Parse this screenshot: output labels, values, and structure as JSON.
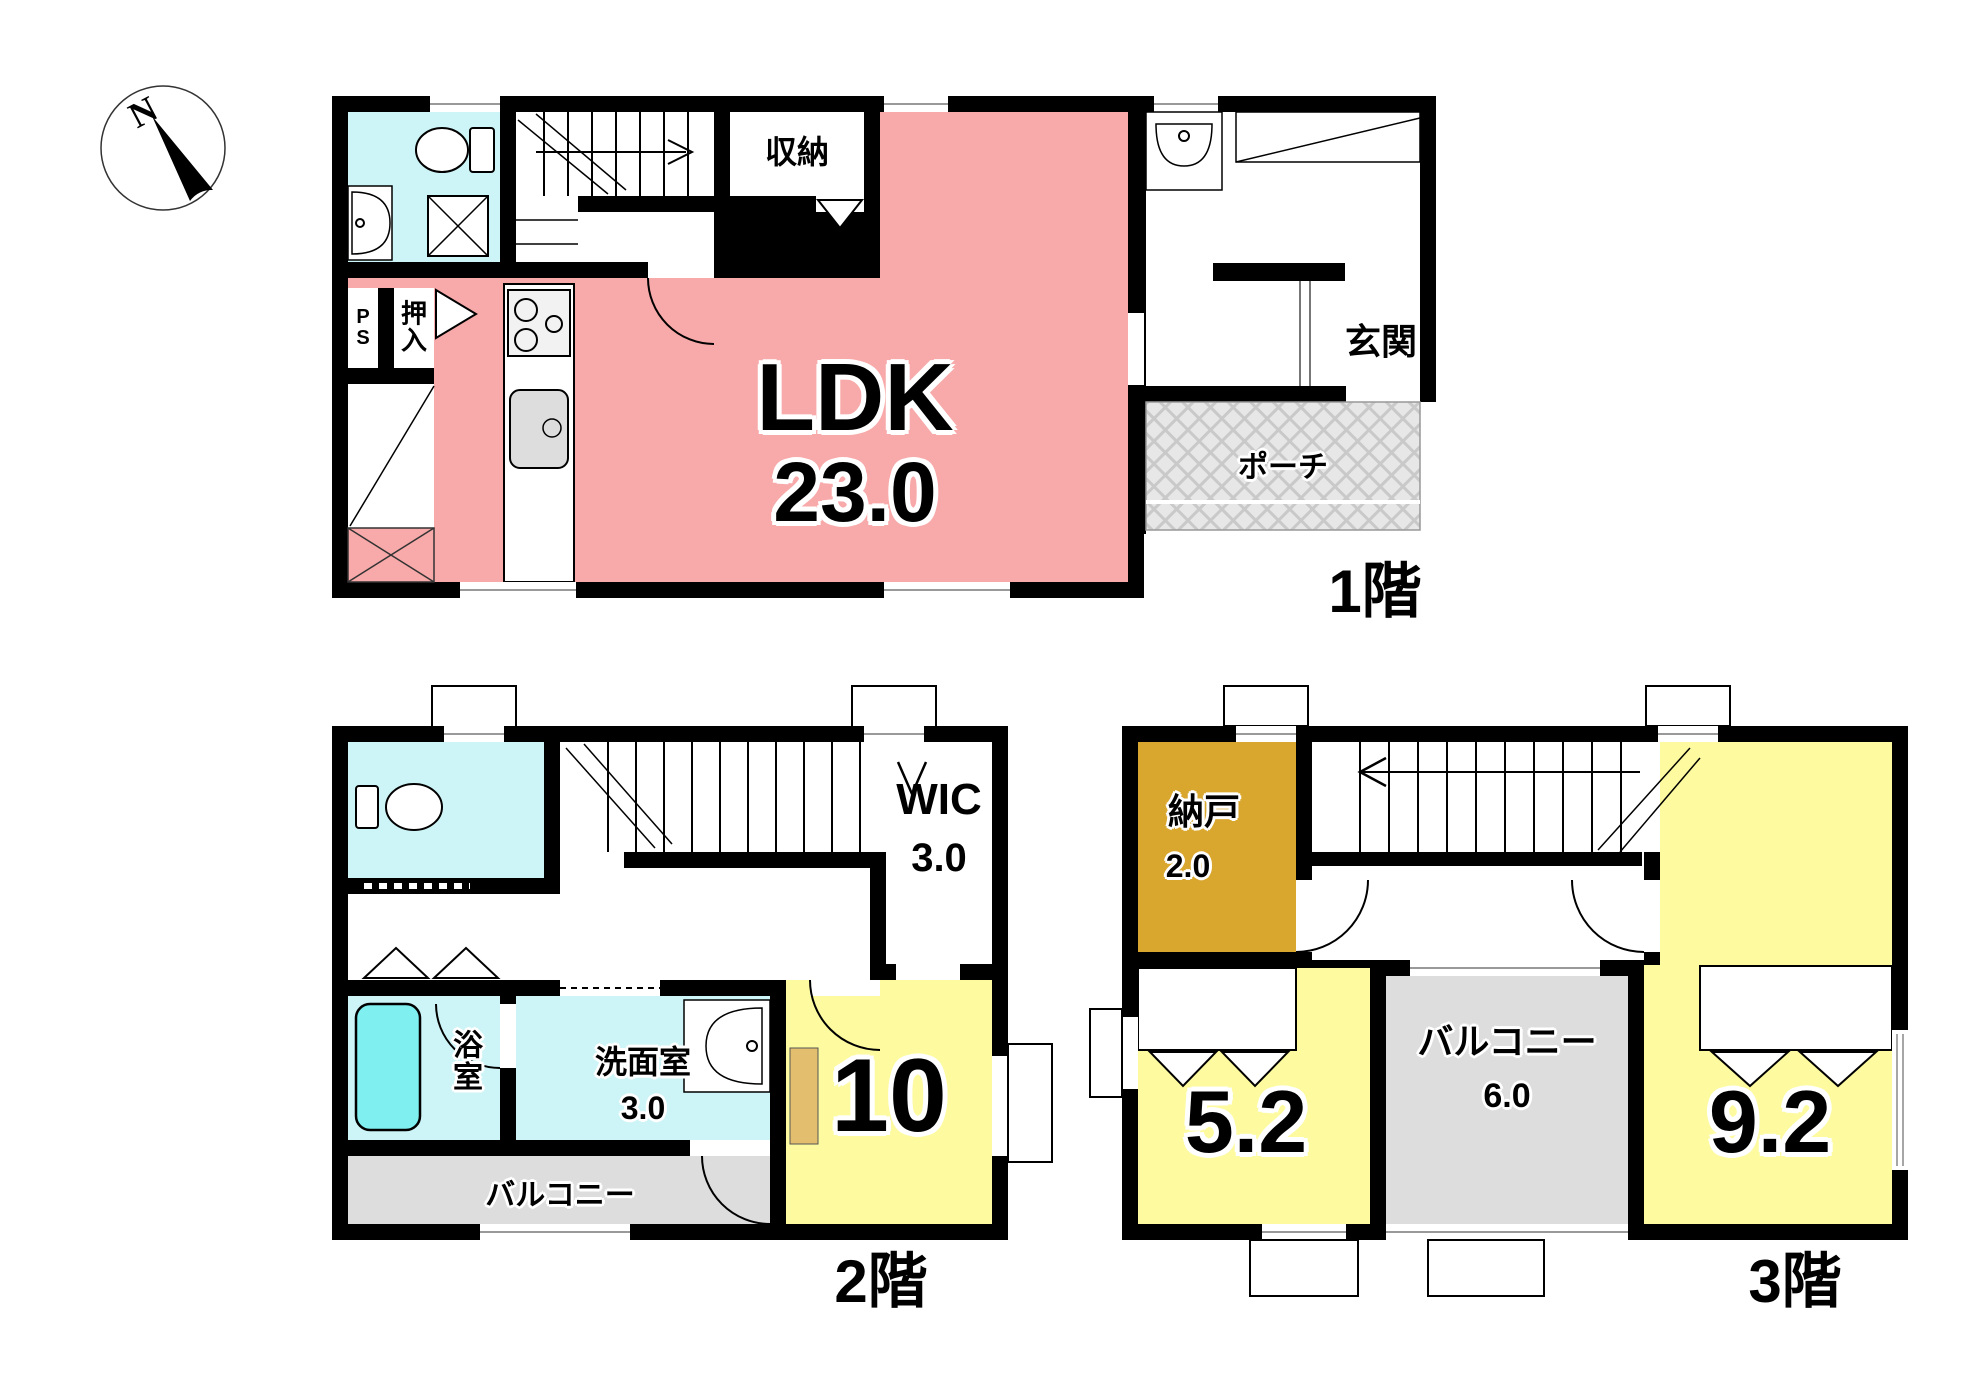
{
  "compass": {
    "label": "N"
  },
  "floor1": {
    "label": "1階",
    "rooms": {
      "ldk": {
        "label": "LDK",
        "size": "23.0"
      },
      "storage": {
        "label": "収納"
      },
      "ps": {
        "label": "PS"
      },
      "oshiire": {
        "label": "押入"
      },
      "genkan": {
        "label": "玄関"
      },
      "porch": {
        "label": "ポーチ"
      }
    }
  },
  "floor2": {
    "label": "2階",
    "rooms": {
      "wic": {
        "label": "WIC",
        "size": "3.0"
      },
      "bathroom": {
        "label": "浴室"
      },
      "washroom": {
        "label": "洗面室",
        "size": "3.0"
      },
      "balcony": {
        "label": "バルコニー"
      },
      "bedroom": {
        "label": "10"
      }
    }
  },
  "floor3": {
    "label": "3階",
    "rooms": {
      "nando": {
        "label": "納戸",
        "size": "2.0"
      },
      "bedroom_small": {
        "label": "5.2"
      },
      "balcony": {
        "label": "バルコニー",
        "size": "6.0"
      },
      "bedroom_large": {
        "label": "9.2"
      }
    }
  },
  "colors": {
    "wall": "#000000",
    "ldk_pink": "#F8A9A9",
    "room_yellow": "#FDFA9F",
    "wet_area_cyan": "#CDF4F6",
    "bathtub_cyan": "#7FEFEF",
    "nando_gold": "#D9A62E",
    "balcony_gray": "#DDDDDD",
    "porch_gray": "#E7E7E7",
    "desk_tan": "#E2BE6E"
  }
}
